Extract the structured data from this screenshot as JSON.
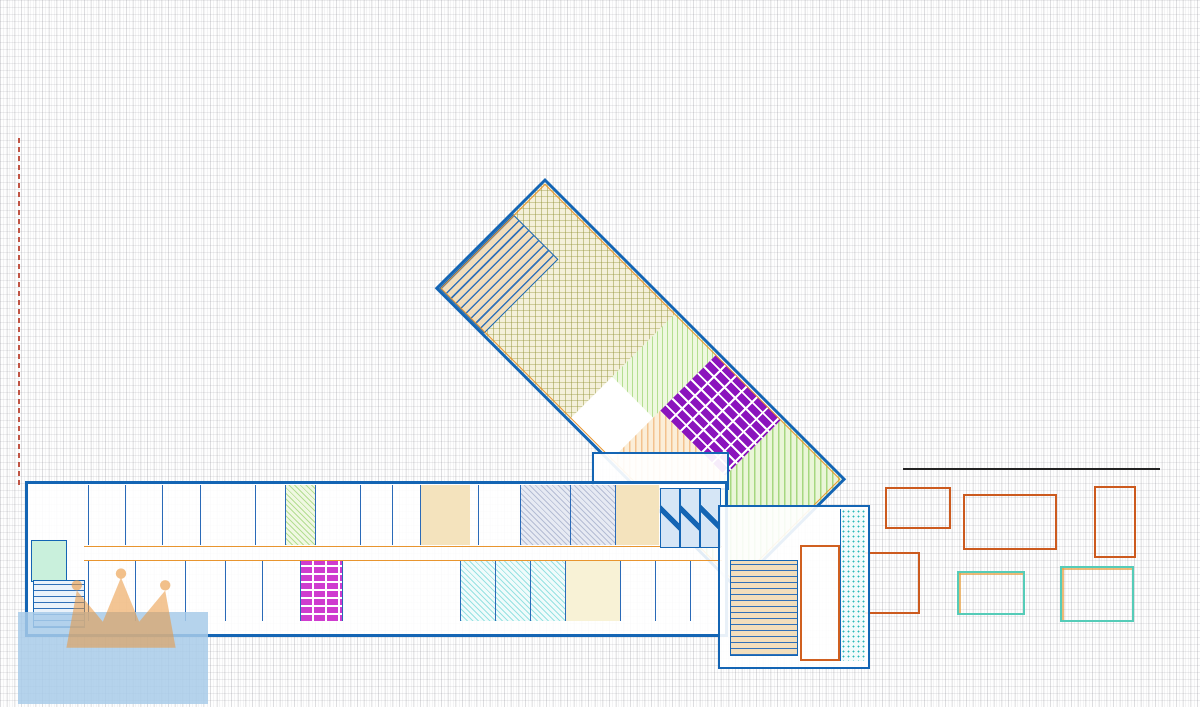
{
  "header": {
    "floor_label": "4.NP",
    "date": "30.9.2024"
  },
  "left_legend": {
    "items": [
      {
        "name": "Naconí",
        "code": "",
        "area": "- 137 m2",
        "color": "#3fc6c6",
        "swatch": "teal-hatch"
      },
      {
        "name": "CINK - Advokátní kancelář",
        "code": "",
        "area": "- 35 m2",
        "color": "#e06038",
        "swatch": "dot-orange"
      },
      {
        "name": "SHOCK s.r.o.",
        "code": "4A4L",
        "area": "- 23 m2",
        "color": "#e8952f",
        "swatch": "outline-orange"
      },
      {
        "name": "Plas",
        "code": "4A1L-B",
        "area": "- 23 m2",
        "color": "#e8952f",
        "swatch": "outline-orange"
      },
      {
        "name": "Přemysl Picař",
        "code": "4A8P",
        "area": "- 23 m2",
        "color": "#e06038",
        "swatch": "outline-orange"
      },
      {
        "name": "volné",
        "code": "4A1L-A",
        "area": "- 23 m2",
        "color": "#f0a830",
        "swatch": "outline-orange"
      },
      {
        "name": "Montravel",
        "code": "4A6P",
        "area": "- 23 m2",
        "color": "#e8882f",
        "swatch": "outline-orange"
      },
      {
        "name": "Hankyu Hanshin Express\n(Deutschland) GmbH",
        "code": "",
        "area": "- 35 m2",
        "color": "#f0a030",
        "swatch": "outline-orange"
      },
      {
        "name": "BELLIS CZECH REPUBLIC s.r.o.",
        "code": "4A10P",
        "area": "- 23 m2",
        "color": "#e07828",
        "swatch": "outline-orange"
      },
      {
        "name": "volné",
        "code": "4A11P",
        "area": "- 23 m2",
        "color": "#e8952f",
        "swatch": "outline-orange"
      },
      {
        "name": "volné",
        "code": "4A12P",
        "area": "- 23 m2",
        "color": "#e8952f",
        "swatch": "outline-orange"
      },
      {
        "name": "Your Energy Solution s.r.o.",
        "code": "4A9L",
        "area": "- 23 m2",
        "color": "#e8882f",
        "swatch": "outline-orange"
      },
      {
        "name": "MODUL HOUSE s.r.o.",
        "code": "4A10L",
        "area": "- 23 m2",
        "color": "#e07828",
        "swatch": "outline-orange"
      },
      {
        "name": "ORTOTIKA, s.r.o.",
        "code": "4A11L",
        "area": "- 23 m2",
        "color": "#e07828",
        "swatch": "outline-orange"
      }
    ]
  },
  "mid_legend": {
    "items": [
      {
        "name": "volné",
        "code": "4A12L",
        "area": "- 46 m2",
        "color": "#e8952f",
        "swatch": "outline-orange"
      },
      {
        "name": "volné",
        "code": "4A13L",
        "area": "- 34 m2",
        "color": "#e8952f",
        "swatch": "outline-orange"
      }
    ]
  },
  "right_legend": {
    "items": [
      {
        "name": "Proceram studio",
        "area": "- 242 m2",
        "color": "#96962e",
        "swatch": "olive"
      },
      {
        "name": "Living Media",
        "area": "- 36 m2",
        "color": "#b8e08a",
        "swatch": "pgreen"
      },
      {
        "name": "Anova Development s.r.o.",
        "area": "- 25 m2",
        "color": "#d44fd4",
        "swatch": "magenta"
      },
      {
        "name": "Elements finanční por.",
        "area": "- 52 m2",
        "color": "#2c3e70",
        "swatch": "navy"
      },
      {
        "name": "Elements finanční por.",
        "area": "- 46,5 m2",
        "color": "#e4c040",
        "swatch": "yellow"
      },
      {
        "name": "Activa",
        "area": "- 77 m2",
        "color": "#d8c090",
        "swatch": "tan"
      },
      {
        "name": "Proceram zasedačka",
        "area": "- 59 m2",
        "color": "#38c4c4",
        "swatch": "tealsw"
      },
      {
        "name": "Plné zastřešení",
        "area": "- 360 m2",
        "color": "#b2ecd0",
        "swatch": "mint"
      },
      {
        "name": "Ekobena",
        "area": "- 66 m2",
        "color": "#8818b8",
        "swatch": "purple"
      },
      {
        "name": "Advanced R&D a.s",
        "area": "- 23 m2",
        "color": "#a8dc80",
        "swatch": "pgreen2"
      },
      {
        "name": "Winning PS -\nstavební firma s.r.o.",
        "area": "- 92 m2",
        "color": "#f2b050",
        "swatch": "orangef"
      },
      {
        "name": "Hanskar Trading",
        "area": "- 86 m2",
        "color": "#86cc50",
        "swatch": "greenf"
      }
    ]
  },
  "plan": {
    "corridor_code_b3": "4B3",
    "corridor_code_b1": "4B1",
    "left_small_area": "30,0 m2",
    "wing": {
      "stair_area": "30,1 m2",
      "main_name": "Proceram",
      "c2_code": "4c2",
      "c2_area": "242 m2",
      "living_name": "Living Media",
      "living_code": "4C4",
      "living_area": "36 m2",
      "ekobena_area": "66 m2",
      "winning_code": "4C3",
      "winning_name": "Winning PS\nstavební\nfirma s.r.o.",
      "hanskar_name": "Hanskar\nTrading",
      "hanskar_code": "4C1",
      "hanskar_area": "86 m2"
    },
    "rooms_top": [
      {
        "code": "4A12P",
        "sub": "volné",
        "area": "23 m2"
      },
      {
        "code": "4A11P",
        "sub": "volné",
        "area": "23 m2"
      },
      {
        "code": "4A10P",
        "sub": "BELLIS\nCZECH\nREPUBLIC\ns.r.o.",
        "area": "23 m2"
      },
      {
        "code": "4A9P",
        "sub": "Hankyu Hanshin\nExpress\n(Deutschland)\nGmbH",
        "area": "35 m2"
      },
      {
        "code": "4A8P",
        "sub": "Přemysl\nPicař",
        "area": "23 m2"
      },
      {
        "code": "4A7P",
        "sub": "Advanced\nR&D a.s.",
        "area": "23 m2"
      },
      {
        "code": "4A6P",
        "sub": "Montravel",
        "area": "23 m2"
      },
      {
        "code": "4A5P",
        "sub": "",
        "area": "23 m2"
      },
      {
        "code": "4A4P",
        "sub": "",
        "area": ""
      },
      {
        "code": "",
        "sub": "Activa",
        "area": "100 m2"
      },
      {
        "code": "4A3P",
        "sub": "CINK\n(advokátní\nkancelář)",
        "area": "35 m2"
      },
      {
        "code": "4A2P",
        "sub": "Elements\nfinanční\nporadenství",
        "area": ""
      },
      {
        "code": "4A1P",
        "sub": "Elements\nfinanční\nporadenství",
        "area": ""
      }
    ],
    "rooms_bottom": [
      {
        "code": "4A13L",
        "sub": "",
        "area": "34 m2"
      },
      {
        "code": "4A12L",
        "sub": "",
        "area": "46 m2"
      },
      {
        "code": "4A11L",
        "sub": "ORTOTIKA\ns.r.o.",
        "area": "23 m2"
      },
      {
        "code": "4A10L",
        "sub": "MODUL\nHOUSE s.r.o.",
        "area": "23 m2"
      },
      {
        "code": "4A9L",
        "sub": "Your Energy\nSolution s.r.o.",
        "area": "23 m2"
      },
      {
        "code": "4A8L",
        "sub": "",
        "area": ""
      },
      {
        "code": "4A7L",
        "sub": "Naconí",
        "area": "34 m2"
      },
      {
        "code": "4A6L",
        "sub": "Naconí",
        "area": "23 m2"
      },
      {
        "code": "4A5L",
        "sub": "Naconí",
        "area": "23 m2"
      },
      {
        "code": "4A4L",
        "sub": "SHOCK s.r.o.",
        "area": "23 m2"
      },
      {
        "code": "4A3L",
        "sub": "Elements finanční\nporadenství",
        "area": "46,5 m2"
      },
      {
        "code": "4A2L",
        "sub": "",
        "area": ""
      },
      {
        "code": "4A1L-B",
        "sub": "Plas",
        "area": "23 m2"
      },
      {
        "code": "4A1L-A",
        "sub": "volné",
        "area": "23 m2"
      }
    ]
  },
  "roof": {
    "area": "482 m2",
    "label1": "Plan\nzastřešení",
    "label2": "Plan\nzastřešení"
  },
  "watermarks": {
    "maxxus_a": "MA",
    "maxxus_b": "XX",
    "maxxus_c": "US",
    "maxxus_sub": "REALITY",
    "bazos": "@(Bazos.cz"
  }
}
